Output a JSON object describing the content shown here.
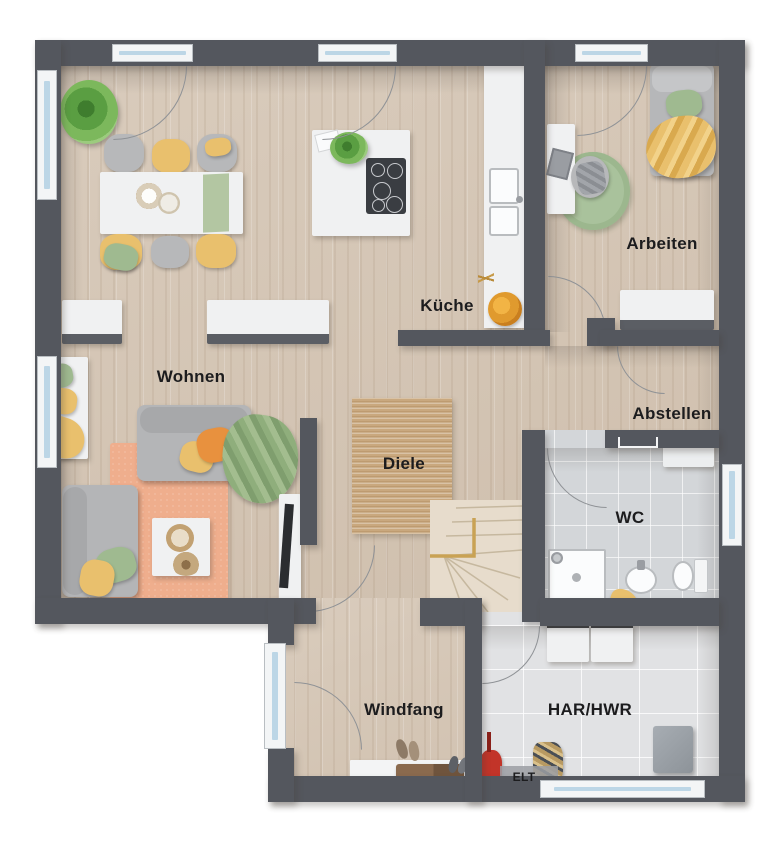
{
  "floor_plan": {
    "rooms": [
      {
        "name": "living-room",
        "label": "Wohnen"
      },
      {
        "name": "kitchen",
        "label": "Küche"
      },
      {
        "name": "office",
        "label": "Arbeiten"
      },
      {
        "name": "storage-room",
        "label": "Abstellen"
      },
      {
        "name": "hallway",
        "label": "Diele"
      },
      {
        "name": "toilet",
        "label": "WC"
      },
      {
        "name": "vestibule",
        "label": "Windfang"
      },
      {
        "name": "utility-room",
        "label": "HAR/HWR"
      },
      {
        "name": "electrical-panel",
        "label": "ELT"
      }
    ],
    "colors": {
      "wall": "#54575e",
      "wood_floor": "#d5c6b5",
      "tile_wc": "#d3d6d9",
      "tile_utility": "#e1e2e4",
      "rug_jute": "#c9a87e",
      "rug_living": "#efae8d",
      "rug_office": "#a9c29c",
      "accent_yellow": "#e9c06d",
      "accent_orange": "#e8913e",
      "accent_green": "#9fba90",
      "window_glass": "#bcd6e6"
    },
    "furniture": [
      "dining-table",
      "dining-chairs",
      "potted-plant",
      "kitchen-island-cooktop",
      "kitchen-counter-sink",
      "fruit-bowl",
      "sideboard",
      "window-bench",
      "sofa",
      "coffee-table",
      "tv-sideboard",
      "daybed",
      "desk",
      "desk-chair",
      "staircase",
      "shower",
      "washbasin",
      "toilet-bowl",
      "shelf",
      "washing-machine",
      "laundry-basket",
      "vacuum",
      "entry-door",
      "doormat",
      "bench"
    ]
  }
}
